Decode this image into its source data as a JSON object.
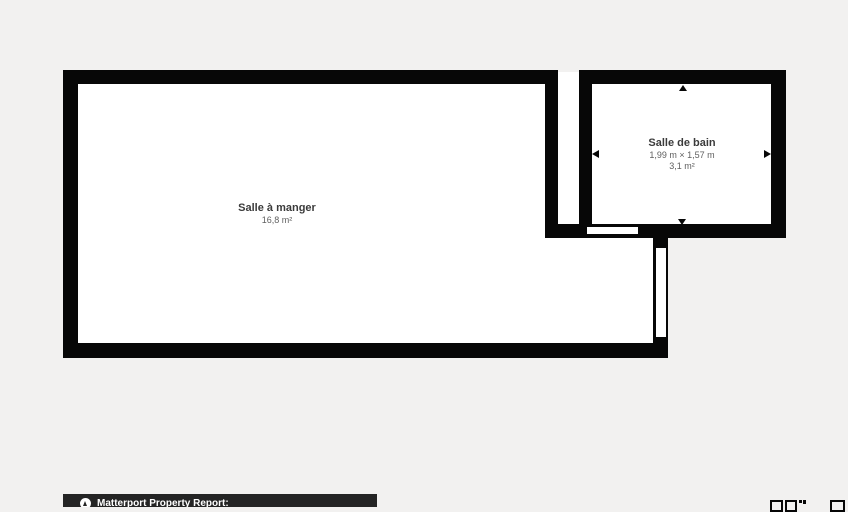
{
  "colors": {
    "background": "#f2f1f0",
    "wall": "#070707",
    "room_floor": "#ffffff",
    "room_name_text": "#3b3b3b",
    "room_sub_text": "#5f5f5f",
    "footer_bar": "#242424",
    "footer_text": "#ffffff"
  },
  "floorplan": {
    "rooms": [
      {
        "id": "salle-a-manger",
        "name": "Salle à manger",
        "area": "16,8 m²"
      },
      {
        "id": "salle-de-bain",
        "name": "Salle de bain",
        "dimensions": "1,99 m × 1,57 m",
        "area": "3,1 m²"
      }
    ],
    "dimension_arrows": [
      "up",
      "down",
      "left",
      "right"
    ]
  },
  "footer": {
    "logo": "matterport-logo",
    "report_label": "Matterport Property Report:"
  }
}
